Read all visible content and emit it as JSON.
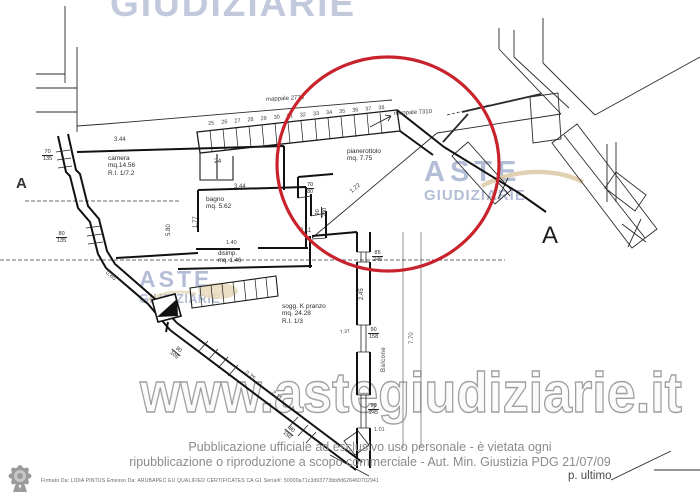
{
  "watermarks": {
    "top_text": "GIUDIZIARIE",
    "logo": {
      "line1": "ASTE",
      "line2": "GIUDIZIARIE"
    },
    "url_text": "www.astegiudiziarie.it",
    "colors": {
      "logo_blue": "#b3bdd6",
      "swoosh_tan": "#dcc9a4",
      "url_outline": "#a0a0a0",
      "top_blue": "#c2c9dc"
    }
  },
  "plan": {
    "parcel_labels": {
      "left": "mappale 2775",
      "right": "mappale 7310"
    },
    "rooms": {
      "camera": {
        "name": "camera",
        "area": "mq.14.56",
        "ratio": "R.I. 1/7.2"
      },
      "bagno": {
        "name": "bagno",
        "area": "mq. 5.62"
      },
      "disimpegno": {
        "name": "disimp.",
        "area": "mq. 1.46"
      },
      "soggiorno": {
        "name": "sogg. K pranzo",
        "area": "mq. 24.28",
        "ratio": "R.I. 1/3"
      },
      "pianerottolo": {
        "name": "pianerottolo",
        "area": "mq. 7.75"
      },
      "balcone": {
        "name": "Balcone"
      }
    },
    "stairs": {
      "numbers": "25 26 27 28 29 30 31 32 33 34 35 36 37 38",
      "start_number": "24"
    },
    "dimensions": {
      "camera_width": "3.44",
      "camera_height": "5.80",
      "bagno_width": "3.44",
      "bagno_height": "1.77",
      "disimpegno_width": "1.40",
      "soggiorno_width": "3.11",
      "landing_diag": "1.22",
      "wall_diag_left": "0.85",
      "balcone_upper": "2.45",
      "balcone_mid": "7.37",
      "balcone_total": "7.70",
      "balcone_lower": "1.01",
      "wall_diag_bottom1": "0.75",
      "wall_diag_bottom2": "2.11"
    },
    "openings": {
      "w1": {
        "w": "70",
        "h": "135"
      },
      "w2": {
        "w": "80",
        "h": "135"
      },
      "w3": {
        "w": "70",
        "h": "80"
      },
      "w4": {
        "w": "90",
        "h": "230"
      },
      "w5": {
        "w": "85",
        "h": "245"
      },
      "w6": {
        "w": "90",
        "h": "158"
      },
      "w7": {
        "w": "90",
        "h": "245"
      },
      "w8": {
        "w": "90",
        "h": "105"
      },
      "w9": {
        "w": "80",
        "h": "150"
      }
    },
    "section_letters": {
      "right": "A",
      "left_edge": "A"
    },
    "annotation_circle_color": "#c8232c"
  },
  "footer": {
    "notice_line1": "Pubblicazione ufficiale ad esclusivo uso personale - è vietata ogni",
    "notice_line2": "ripubblicazione o riproduzione a scopo commerciale - Aut. Min. Giustizia PDG 21/07/09",
    "signature": "Firmato Da: LIDIA PINTUS Emesso Da: ARUBAPEC EU QUALIFIED CERTIFICATES CA G1 Serial#: 50000a71c3d93773bb8d626460702941",
    "page_label": "p. ultimo"
  }
}
